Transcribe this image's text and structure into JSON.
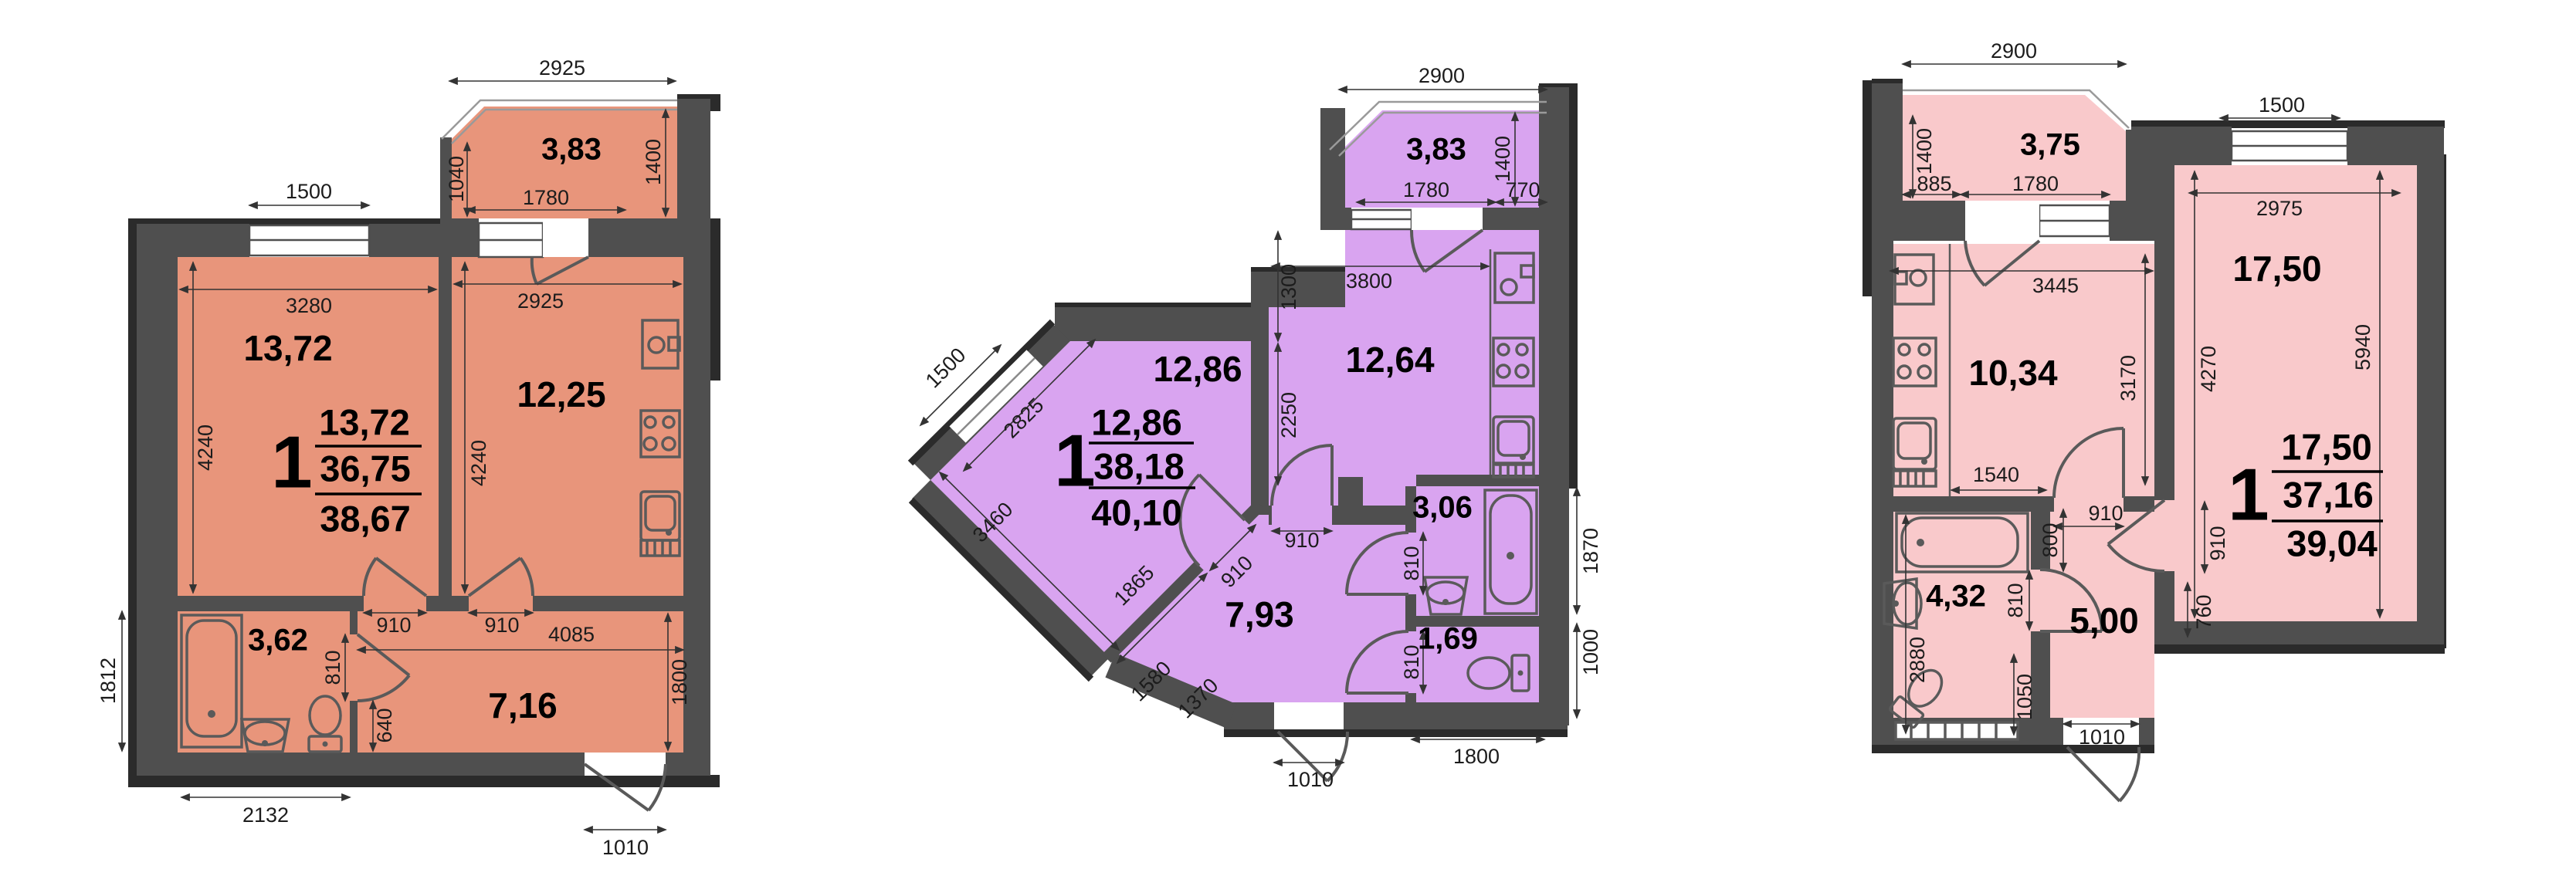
{
  "colors": {
    "plan1": "#e8957b",
    "plan2": "#d9a4f0",
    "plan3": "#f9c9cb",
    "wall": "#4f4f4f"
  },
  "plans": [
    {
      "name": "plan-a",
      "summary": {
        "rooms": "1",
        "top": "13,72",
        "middle": "36,75",
        "bottom": "38,67"
      },
      "areas": {
        "living": "13,72",
        "kitchen": "12,25",
        "bath": "3,62",
        "hall": "7,16",
        "balcony": "3,83"
      },
      "dims": {
        "balcony_top": "2925",
        "balcony_left": "1040",
        "balcony_right": "1400",
        "balcony_inner": "1780",
        "window_top": "1500",
        "living_w": "3280",
        "living_h": "4240",
        "kitchen_w": "2925",
        "kitchen_h": "4240",
        "living_door": "910",
        "kitchen_door": "910",
        "hall_w": "4085",
        "hall_h": "1800",
        "bath_door": "810",
        "niche": "640",
        "side_left": "1812",
        "bottom_bath": "2132",
        "entry": "1010"
      }
    },
    {
      "name": "plan-b",
      "summary": {
        "rooms": "1",
        "top": "12,86",
        "middle": "38,18",
        "bottom": "40,10"
      },
      "areas": {
        "living": "12,86",
        "kitchen": "12,64",
        "bath": "3,06",
        "wc": "1,69",
        "hall": "7,93",
        "balcony": "3,83"
      },
      "dims": {
        "balcony_top": "2900",
        "balcony_right": "1400",
        "balcony_in_l": "1780",
        "balcony_in_r": "770",
        "kitchen_w": "3800",
        "wall_top": "1300",
        "wall_mid": "2250",
        "window_diag": "1500",
        "living_edge_top": "2825",
        "living_edge_bottom": "3460",
        "hall_edge": "1865",
        "living_door": "910",
        "kitchen_door": "910",
        "step1": "1580",
        "step2": "1370",
        "bath_door": "810",
        "wc_door": "810",
        "bath_h": "1870",
        "wc_h": "1000",
        "bottom": "1800",
        "entry": "1010"
      }
    },
    {
      "name": "plan-c",
      "summary": {
        "rooms": "1",
        "top": "17,50",
        "middle": "37,16",
        "bottom": "39,04"
      },
      "areas": {
        "living": "17,50",
        "kitchen": "10,34",
        "bath": "4,32",
        "hall": "5,00",
        "balcony": "3,75"
      },
      "dims": {
        "balcony_top": "2900",
        "balcony_left": "1400",
        "balcony_in_l": "885",
        "balcony_in_r": "1780",
        "window_top": "1500",
        "living_w": "2975",
        "living_h_l": "4270",
        "living_h_r": "5940",
        "kitchen_w": "3445",
        "kitchen_h": "3170",
        "kitchen_b": "1540",
        "kitchen_door": "910",
        "hall_top": "800",
        "bath_door": "810",
        "living_door": "910",
        "stub": "760",
        "bath_h": "2880",
        "niche": "1050",
        "entry": "1010"
      }
    }
  ]
}
